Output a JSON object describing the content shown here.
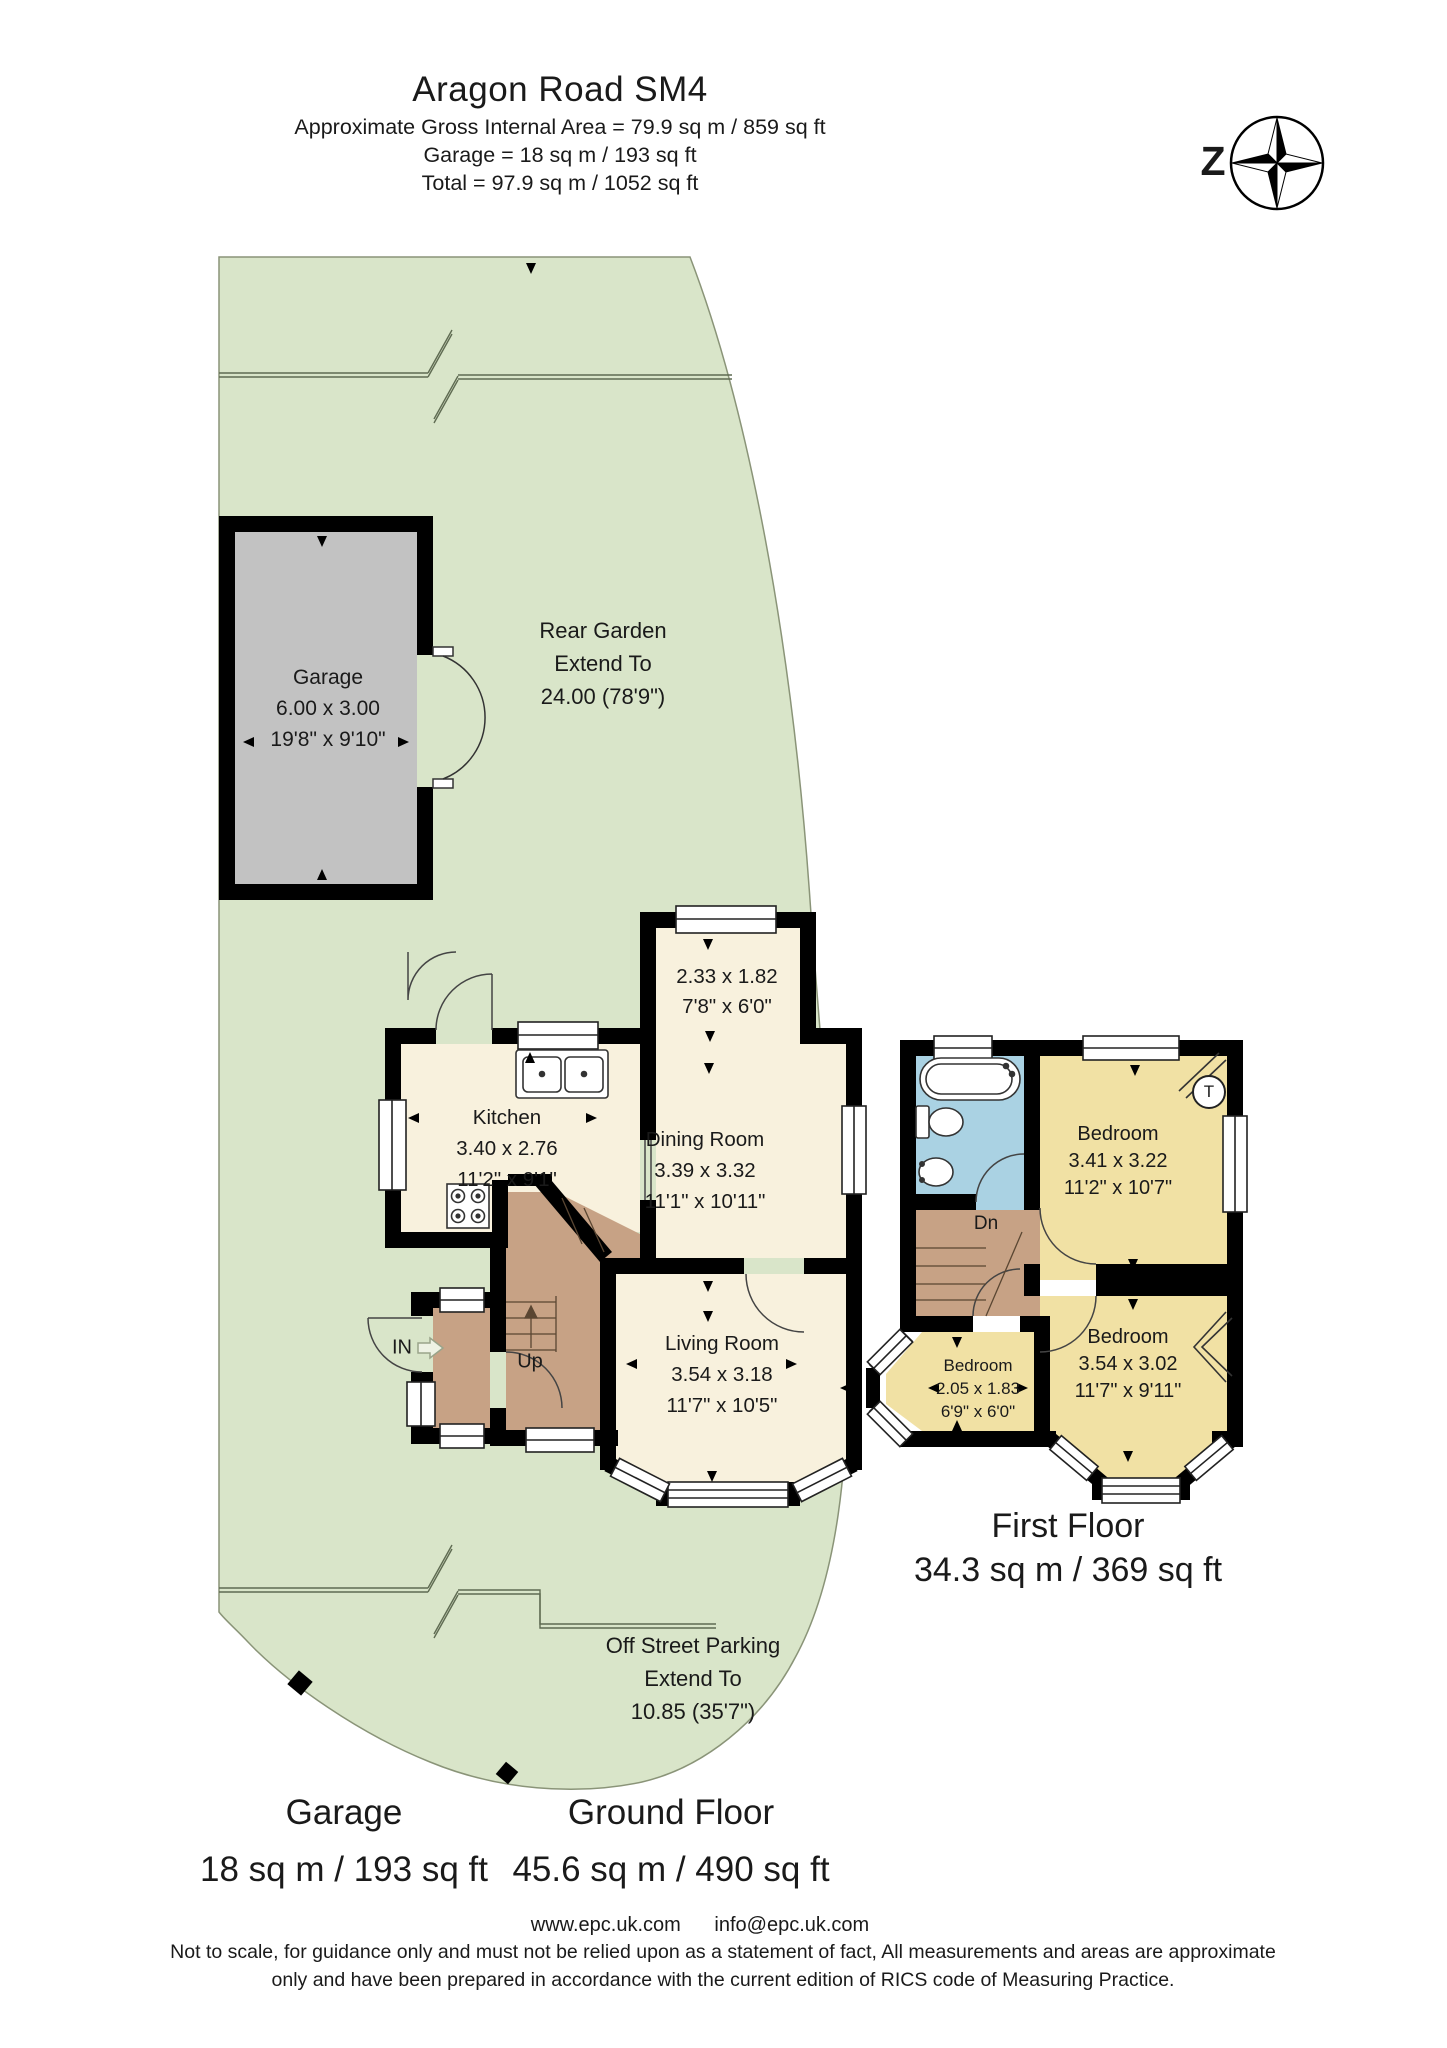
{
  "header": {
    "title": "Aragon Road SM4",
    "line1": "Approximate Gross Internal Area = 79.9 sq m / 859 sq ft",
    "line2": "Garage = 18 sq m / 193 sq ft",
    "line3": "Total = 97.9 sq m / 1052 sq ft"
  },
  "compass": {
    "letter": "Z"
  },
  "garden": {
    "rear": {
      "l1": "Rear Garden",
      "l2": "Extend To",
      "l3": "24.00 (78'9\")"
    },
    "parking": {
      "l1": "Off Street Parking",
      "l2": "Extend To",
      "l3": "10.85 (35'7\")"
    }
  },
  "rooms": {
    "garage": {
      "name": "Garage",
      "metric": "6.00 x 3.00",
      "imperial": "19'8\" x 9'10\""
    },
    "kitchen": {
      "name": "Kitchen",
      "metric": "3.40 x 2.76",
      "imperial": "11'2\" x 9'1\""
    },
    "dining": {
      "name": "Dining Room",
      "metric": "3.39 x 3.32",
      "imperial": "11'1\" x 10'11\""
    },
    "bay": {
      "metric": "2.33 x 1.82",
      "imperial": "7'8\" x 6'0\""
    },
    "living": {
      "name": "Living Room",
      "metric": "3.54 x 3.18",
      "imperial": "11'7\" x 10'5\""
    },
    "bed1": {
      "name": "Bedroom",
      "metric": "3.41 x 3.22",
      "imperial": "11'2\" x 10'7\""
    },
    "bed2": {
      "name": "Bedroom",
      "metric": "2.05 x 1.83",
      "imperial": "6'9\" x 6'0\""
    },
    "bed3": {
      "name": "Bedroom",
      "metric": "3.54 x 3.02",
      "imperial": "11'7\" x 9'11\""
    },
    "labels": {
      "up": "Up",
      "dn": "Dn",
      "entry": "IN",
      "tank": "T"
    }
  },
  "floors": {
    "first": {
      "name": "First Floor",
      "area": "34.3 sq m / 369 sq ft"
    },
    "garage": {
      "name": "Garage",
      "area": "18 sq m / 193 sq ft"
    },
    "ground": {
      "name": "Ground Floor",
      "area": "45.6 sq m / 490 sq ft"
    }
  },
  "footer": {
    "website": "www.epc.uk.com",
    "email": "info@epc.uk.com",
    "disclaimer1": "Not to scale, for guidance only and must not be relied upon as a statement of fact, All measurements and areas are approximate",
    "disclaimer2": "only and have been prepared in accordance with the current edition of RICS code of Measuring Practice."
  },
  "colors": {
    "garden": "#d9e5c9",
    "garden_edge": "#8a9478",
    "garage": "#c2c2c2",
    "room": "#f8f1dd",
    "bedroom": "#f1e1a4",
    "bath": "#aad2e3",
    "hall": "#c7a285",
    "wall": "#000000"
  }
}
